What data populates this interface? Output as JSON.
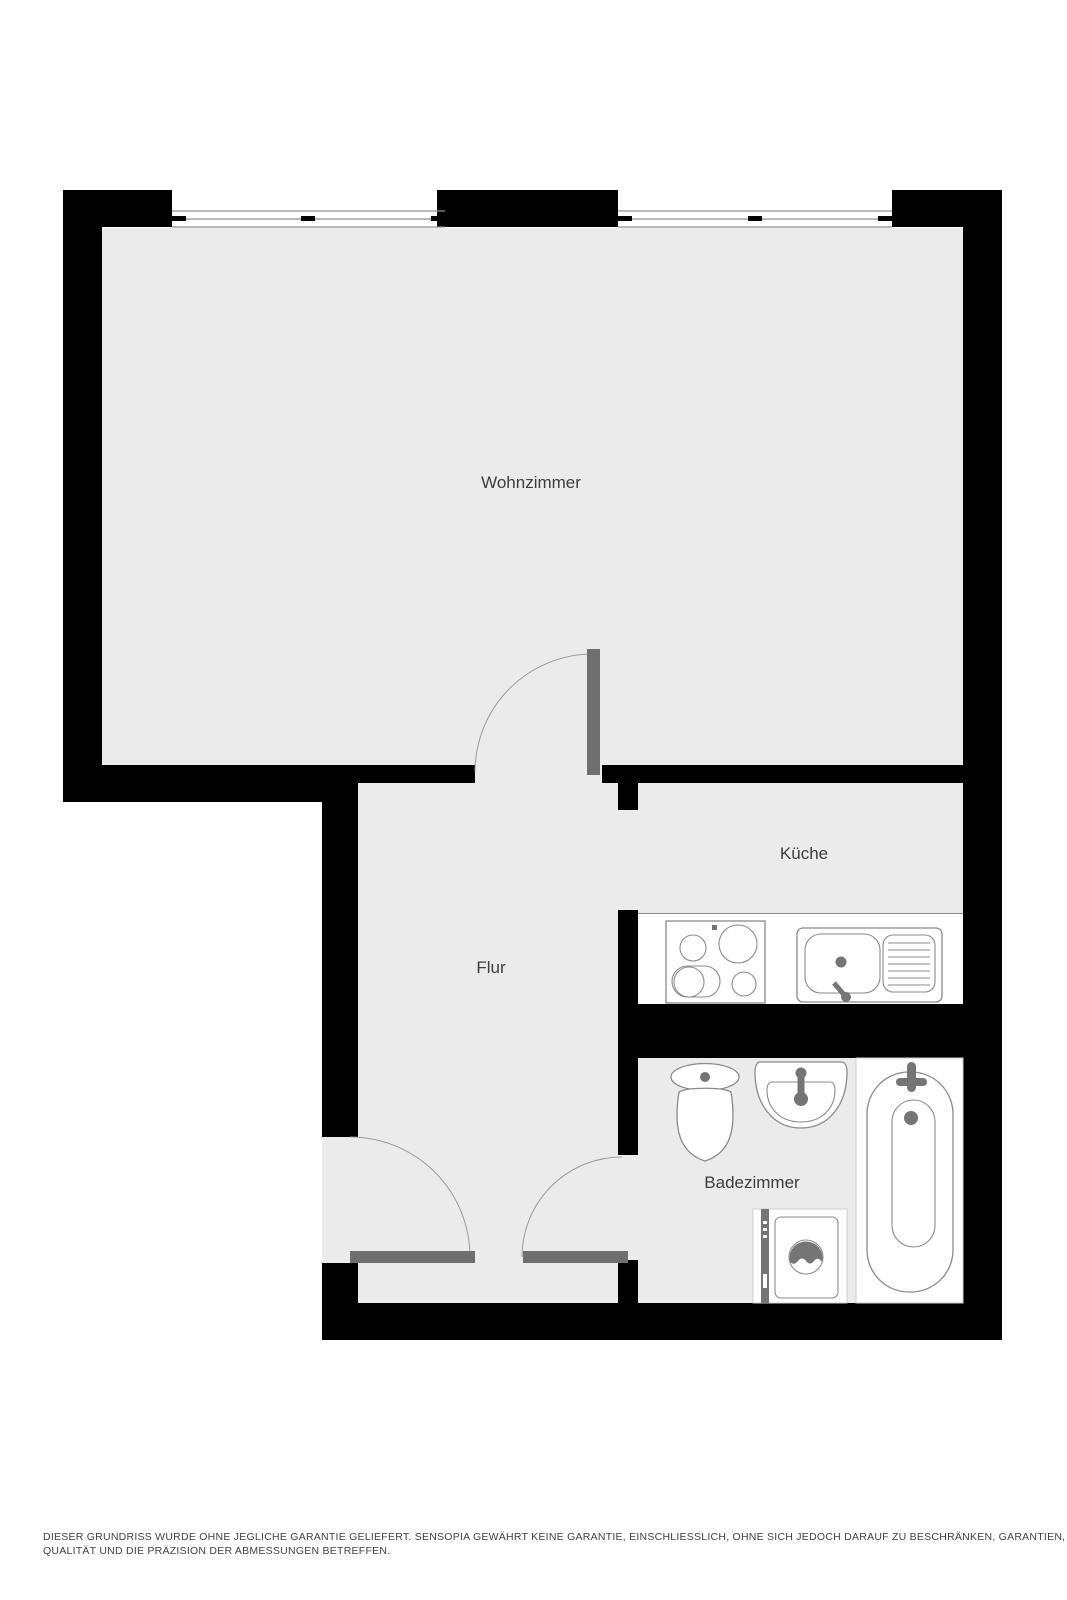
{
  "plan_type": "floor-plan",
  "rooms": {
    "wohnzimmer": {
      "label": "Wohnzimmer"
    },
    "kueche": {
      "label": "Küche"
    },
    "flur": {
      "label": "Flur"
    },
    "badezimmer": {
      "label": "Badezimmer"
    }
  },
  "fixtures": {
    "kitchen": [
      "stove-icon",
      "kitchen-sink-icon"
    ],
    "bathroom": [
      "toilet-icon",
      "washbasin-icon",
      "bathtub-icon",
      "washing-machine-icon"
    ],
    "doors": [
      "entrance-door",
      "living-room-door",
      "bathroom-door"
    ],
    "windows": [
      "window-left",
      "window-right"
    ]
  },
  "disclaimer": {
    "line1": "DIESER GRUNDRISS WURDE OHNE JEGLICHE GARANTIE GELIEFERT. SENSOPIA GEWÄHRT KEINE GARANTIE, EINSCHLIESSLICH, OHNE SICH JEDOCH DARAUF ZU BESCHRÄNKEN, GARANTIEN, DIE DIE",
    "line2": "QUALITÄT UND DIE PRÄZISION DER ABMESSUNGEN BETREFFEN."
  },
  "colors": {
    "wall": "#000000",
    "floor": "#ebebeb",
    "counter": "#ffffff",
    "door": "#6f6f6f",
    "arc": "#9a9a9a",
    "window-line": "#8f8f8f",
    "fixture": "#8a8a8a",
    "fixture-dark": "#757575",
    "label": "#3d3d3d",
    "disclaimer": "#414141"
  }
}
